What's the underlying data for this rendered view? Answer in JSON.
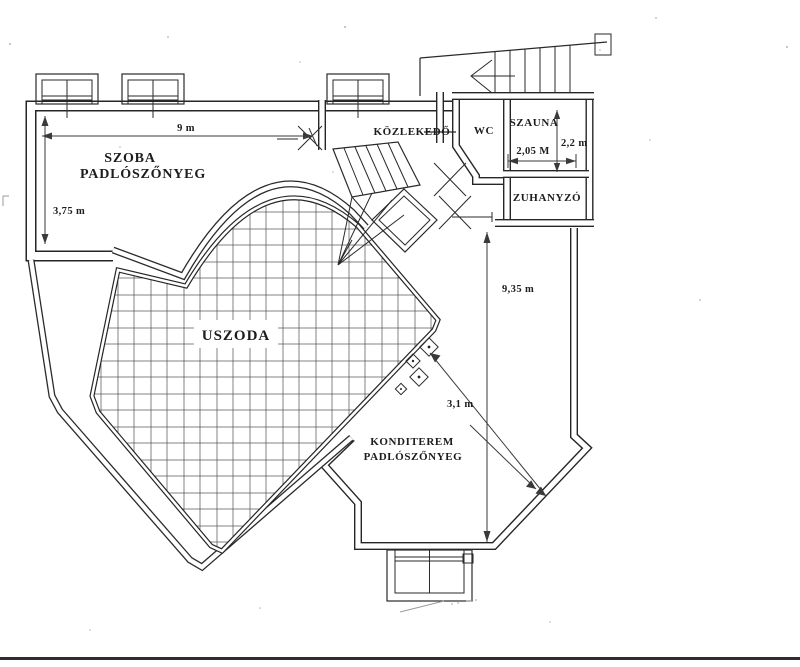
{
  "document": {
    "kind_label": "floor plan (scanned)",
    "language": "Hungarian"
  },
  "labels": {
    "szoba_line1": "SZOBA",
    "szoba_line2": "PADLÓSZŐNYEG",
    "kozlekedo": "KÖZLEKEDŐ",
    "wc": "WC",
    "szauna": "SZAUNA",
    "zuhanyzo": "ZUHANYZÓ",
    "uszoda": "USZODA",
    "konditerem_line1": "KONDITEREM",
    "konditerem_line2": "PADLÓSZŐNYEG"
  },
  "dimensions": {
    "szoba_width": "9 m",
    "szoba_height": "3,75 m",
    "szauna_width": "2,05 M",
    "szauna_height": "2,2 m",
    "konditerem_height": "9,35 m",
    "pool_to_corner": "3,1 m"
  },
  "colors": {
    "ink": "#262626",
    "paper": "#ffffff",
    "dimension_lines": "#3a3a3a",
    "pool_grid": "#4a4a4a",
    "pencil_marks": "#9a9a9a"
  }
}
